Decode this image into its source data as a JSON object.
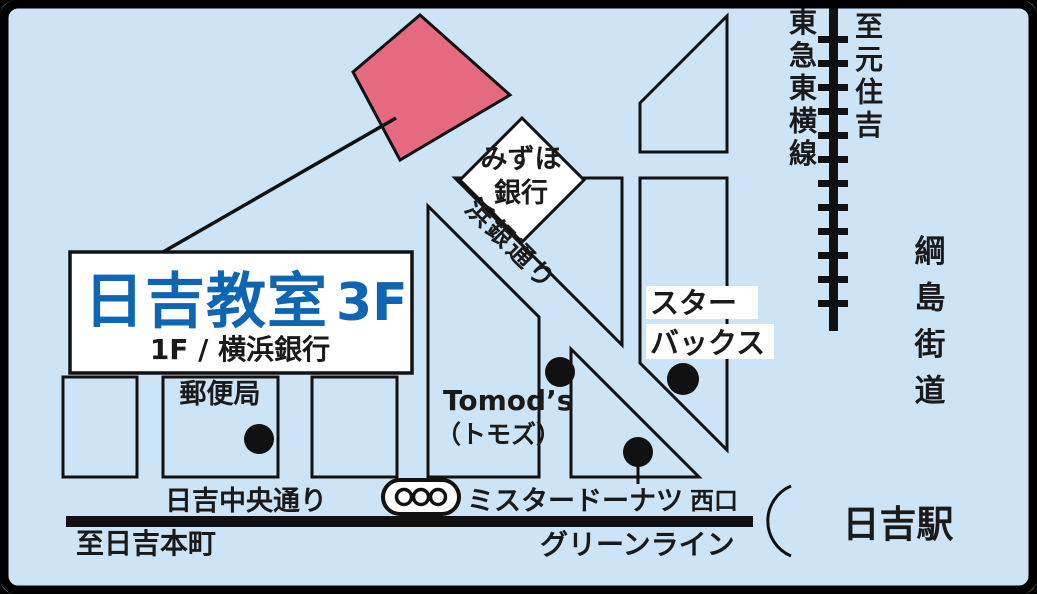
{
  "map": {
    "destination": {
      "title": "日吉教室",
      "floor": "3F",
      "subtitle": "1F / 横浜銀行"
    },
    "landmarks": {
      "mizuho_line1": "みずほ",
      "mizuho_line2": "銀行",
      "post_office": "郵便局",
      "tomods_en": "Tomod’s",
      "tomods_jp": "（トモズ）",
      "starbucks_line1": "スター",
      "starbucks_line2": "バックス",
      "mister_donut": "ミスタードーナツ"
    },
    "roads": {
      "hamagin_dori": "浜銀通り",
      "hiyoshi_chuo_dori": "日吉中央通り",
      "tsunashima_kaido": "綱島街道",
      "green_line": "グリーンライン"
    },
    "station": {
      "name": "日吉駅",
      "west_exit": "西口",
      "railway_name": "東急東横線"
    },
    "directions": {
      "to_motosumiyoshi": "至元住吉",
      "to_hiyoshi_honcho": "至日吉本町"
    },
    "colors": {
      "background": "#cde4f6",
      "highlight_pink": "#e56a80",
      "title_blue": "#0e66b2",
      "ink": "#111111"
    }
  }
}
